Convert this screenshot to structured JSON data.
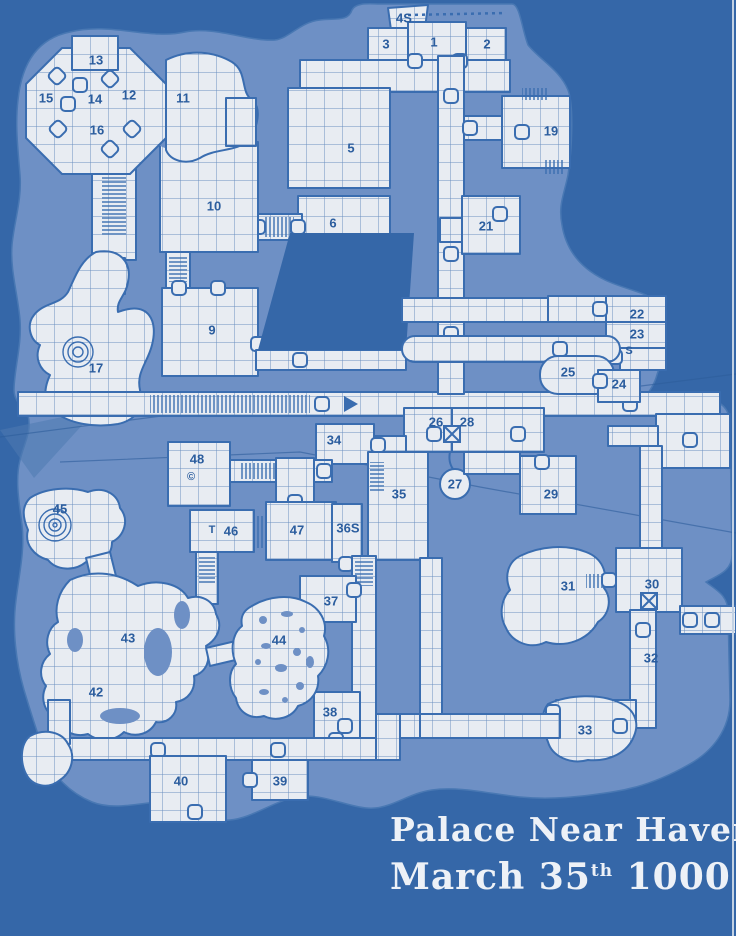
{
  "title": {
    "line1": "Palace Near Haven",
    "line2_main": "March 35",
    "line2_sup": "th",
    "line2_rest": " 1000 AC"
  },
  "colors": {
    "bg": "#3567a8",
    "sheet": "#6e90c5",
    "room": "#e8ecf2",
    "grid": "#6b8fc0",
    "line": "#3a6db0",
    "label": "#2b5d9e",
    "title": "#edf1f7",
    "edge": "#c3d2e4"
  },
  "map": {
    "rooms": [
      {
        "label": "1",
        "x": 434,
        "y": 42
      },
      {
        "label": "2",
        "x": 487,
        "y": 44
      },
      {
        "label": "3",
        "x": 386,
        "y": 44
      },
      {
        "label": "4S",
        "x": 404,
        "y": 18
      },
      {
        "label": "5",
        "x": 351,
        "y": 148
      },
      {
        "label": "6",
        "x": 333,
        "y": 223
      },
      {
        "label": "9",
        "x": 212,
        "y": 330
      },
      {
        "label": "10",
        "x": 214,
        "y": 206
      },
      {
        "label": "11",
        "x": 183,
        "y": 98
      },
      {
        "label": "12",
        "x": 129,
        "y": 95
      },
      {
        "label": "13",
        "x": 96,
        "y": 60
      },
      {
        "label": "14",
        "x": 95,
        "y": 99
      },
      {
        "label": "15",
        "x": 46,
        "y": 98
      },
      {
        "label": "16",
        "x": 97,
        "y": 130
      },
      {
        "label": "17",
        "x": 96,
        "y": 368
      },
      {
        "label": "19",
        "x": 551,
        "y": 131
      },
      {
        "label": "21",
        "x": 486,
        "y": 226
      },
      {
        "label": "22",
        "x": 637,
        "y": 314
      },
      {
        "label": "23",
        "x": 637,
        "y": 334
      },
      {
        "label": "24",
        "x": 619,
        "y": 384
      },
      {
        "label": "25",
        "x": 568,
        "y": 372
      },
      {
        "label": "26",
        "x": 436,
        "y": 422
      },
      {
        "label": "27",
        "x": 455,
        "y": 484
      },
      {
        "label": "28",
        "x": 467,
        "y": 422
      },
      {
        "label": "29",
        "x": 551,
        "y": 494
      },
      {
        "label": "30",
        "x": 652,
        "y": 584
      },
      {
        "label": "31",
        "x": 568,
        "y": 586
      },
      {
        "label": "32",
        "x": 651,
        "y": 658
      },
      {
        "label": "33",
        "x": 585,
        "y": 730
      },
      {
        "label": "34",
        "x": 334,
        "y": 440
      },
      {
        "label": "35",
        "x": 399,
        "y": 494
      },
      {
        "label": "36S",
        "x": 348,
        "y": 528
      },
      {
        "label": "37",
        "x": 331,
        "y": 601
      },
      {
        "label": "38",
        "x": 330,
        "y": 712
      },
      {
        "label": "39",
        "x": 280,
        "y": 781
      },
      {
        "label": "40",
        "x": 181,
        "y": 781
      },
      {
        "label": "42",
        "x": 96,
        "y": 692
      },
      {
        "label": "43",
        "x": 128,
        "y": 638
      },
      {
        "label": "44",
        "x": 279,
        "y": 640
      },
      {
        "label": "45",
        "x": 60,
        "y": 509
      },
      {
        "label": "46",
        "x": 231,
        "y": 531
      },
      {
        "label": "47",
        "x": 297,
        "y": 530
      },
      {
        "label": "48",
        "x": 197,
        "y": 459
      }
    ],
    "annotations": [
      {
        "label": "S",
        "x": 629,
        "y": 351
      },
      {
        "label": "T",
        "x": 212,
        "y": 530
      },
      {
        "label": "©",
        "x": 191,
        "y": 477
      }
    ]
  }
}
